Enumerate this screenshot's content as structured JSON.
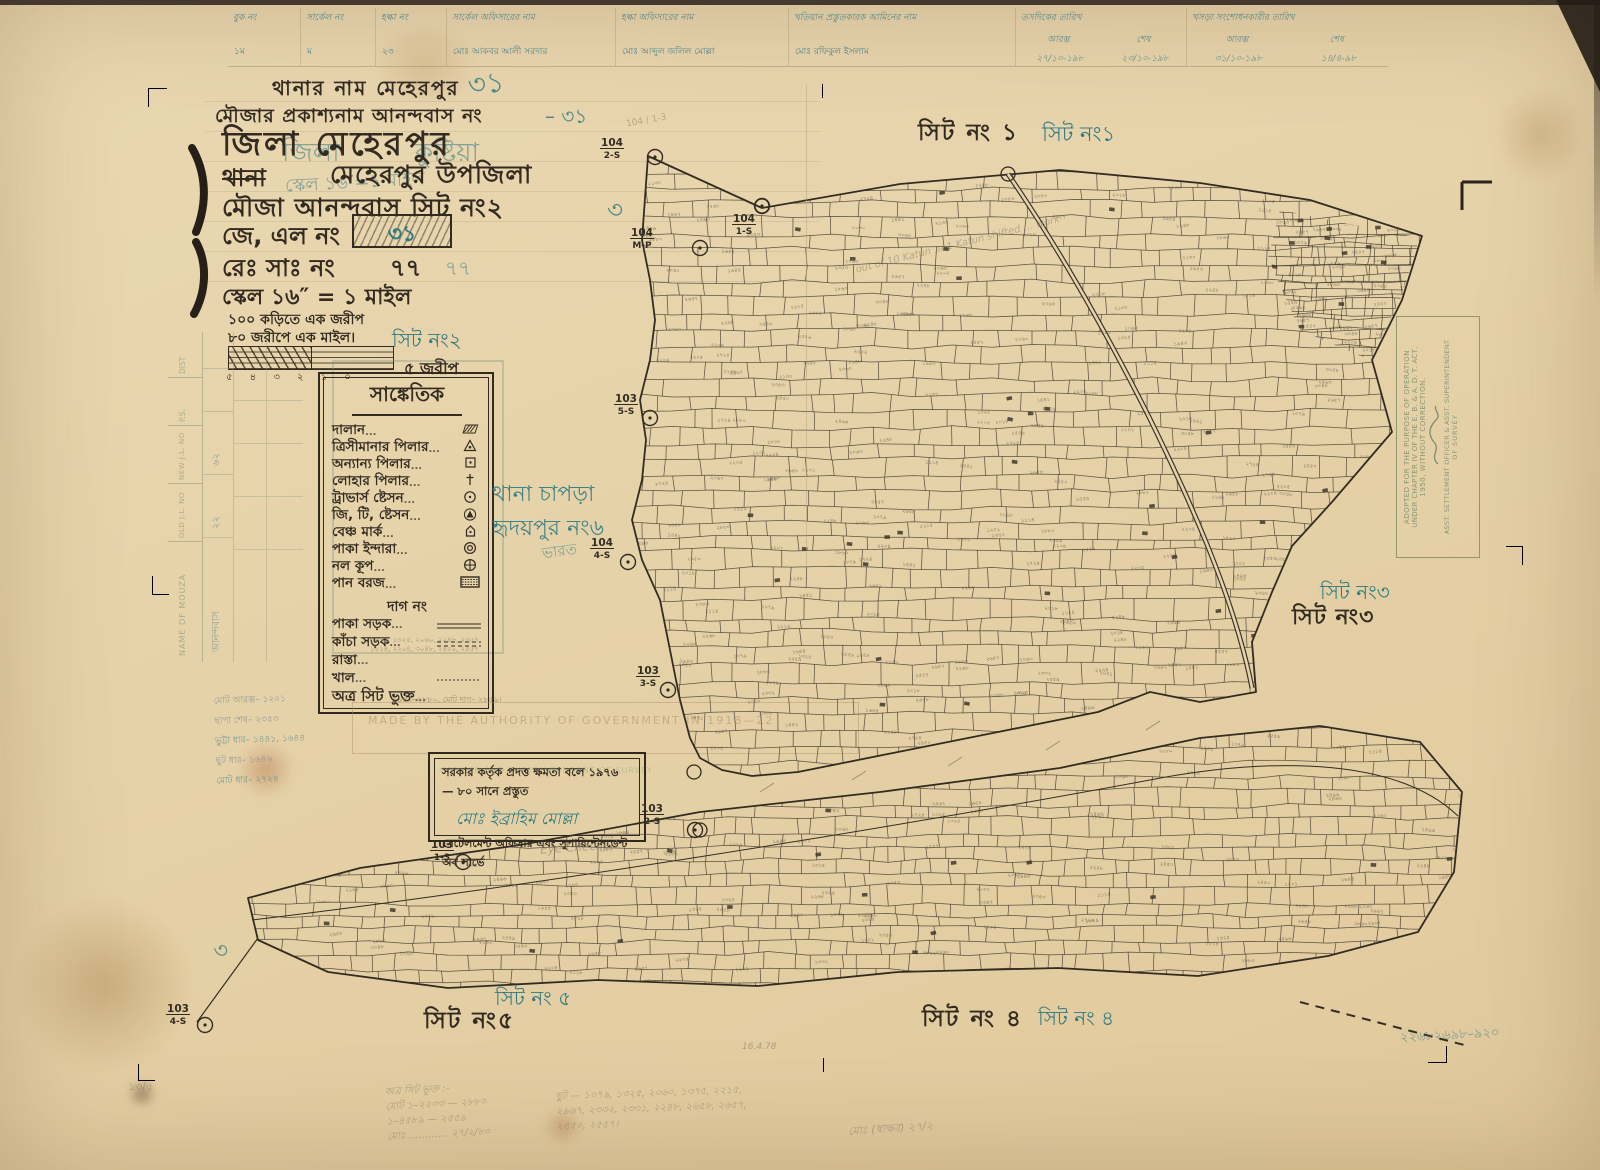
{
  "top_table": {
    "headers": [
      "বুক নং",
      "সার্কেল নং",
      "হল্কা নং",
      "সার্কেল অফিসারের নাম",
      "হল্কা অফিসারের নাম",
      "খতিয়ান প্রস্তুতকারক আমিনের নাম"
    ],
    "date_group1_label": "তসদিকের তারিখ",
    "date_group2_label": "খসড়া সংশোধনকারীর তারিখ",
    "sub_start": "আরম্ভ",
    "sub_end": "শেষ",
    "values": [
      "১ম",
      "ম",
      "২৩",
      "মোঃ আকবর আলী সরদার",
      "মোঃ আব্দুল জলিল মোল্লা",
      "মোঃ রফিকুল ইসলাম",
      "২৭/১০-১৯৮",
      "২৩/১০-১৯৮",
      "৩১/১০-১৯৮",
      "১৪/৪-৯৮"
    ]
  },
  "header": {
    "line_thana": "থানার নাম  মেহেরপুর",
    "line_mouza_name": "মৌজার প্রকাশ্যনাম  আনন্দবাস নং",
    "mouza_no_teal": "– ৩১",
    "big_31_teal": "৩১",
    "district_line": "জিলা  মেহেরপুর",
    "ghost_district": "জিলা",
    "ghost_kushtia": "কুষ্টিয়া",
    "struck_thana": "থানা",
    "ghost_scale": "স্কেল ১৬″=১ মাইল",
    "upazila": "মেহেরপুর উপজিলা",
    "mouza_line": "মৌজা   আনন্দবাস  সিট নং২",
    "jl_label": "জে, এল নং",
    "jl_value": "৩১",
    "rs_label": "রেঃ সাঃ নং",
    "rs_value": "৭৭",
    "rs_ghost": "৭৭",
    "scale_line": "স্কেল ১৬″ = ১ মাইল",
    "scale_note1": "১০০ কড়িতে এক জরীপ",
    "scale_note2": "৮০ জরীপে এক মাইল।",
    "scalebar_ticks": "৫ ৪ ৩ ২ ১ ০",
    "scalebar_right": "৫ জরীপ"
  },
  "legend": {
    "title": "সাঙ্কেতিক",
    "items": [
      {
        "label": "দালান",
        "symbol": "building"
      },
      {
        "label": "ত্রিসীমানার পিলার",
        "symbol": "tri-boundary-pillar"
      },
      {
        "label": "অন্যান্য পিলার",
        "symbol": "other-pillar"
      },
      {
        "label": "লোহার পিলার",
        "symbol": "iron-pillar"
      },
      {
        "label": "ট্রাভার্স ষ্টেসন",
        "symbol": "traverse-station"
      },
      {
        "label": "জি, টি, ষ্টেসন",
        "symbol": "gt-station"
      },
      {
        "label": "বেঞ্চ মার্ক",
        "symbol": "bench-mark"
      },
      {
        "label": "পাকা ইন্দারা",
        "symbol": "pucca-well"
      },
      {
        "label": "নল কূপ",
        "symbol": "tube-well"
      },
      {
        "label": "পান বরজ",
        "symbol": "betel-grove"
      }
    ],
    "dag_no": "দাগ নং",
    "roads": [
      {
        "label": "পাকা সড়ক"
      },
      {
        "label": "কাঁচা সড়ক"
      },
      {
        "label": "রাস্তা"
      },
      {
        "label": "খাল"
      },
      {
        "label": "অত্র সিট ভুক্ত"
      }
    ],
    "road_numbers": "১০৭৯, ১৩২৫, ২০৬০, ২২৪৮, ২৬৫৭, ১১১৪, ২২০৪, ৩০৪৮, ২৪৫০, ২৫৫৭",
    "this_sheet_note": "১৯৪৩–২৮৮০, মোট দাগ– ২৮৫৯।"
  },
  "sheet_labels": {
    "s1_black": "সিট নং ১",
    "s1_teal": "সিট নং১",
    "s2_teal": "সিট নং২",
    "s3_teal": "সিট নং৩",
    "s3_black": "সিট নং৩",
    "s4_black": "সিট নং ৪",
    "s4_teal": "সিট নং ৪",
    "s5_teal": "সিট নং ৫",
    "s5_black": "সিট নং৫"
  },
  "stations": [
    {
      "num": "104",
      "sub": "2-S",
      "lx": 612,
      "ly": 146,
      "cx": 655,
      "cy": 157
    },
    {
      "num": "104",
      "sub": "1-S",
      "lx": 744,
      "ly": 222,
      "cx": 762,
      "cy": 206
    },
    {
      "num": "104",
      "sub": "M-P",
      "lx": 642,
      "ly": 236,
      "cx": 700,
      "cy": 248
    },
    {
      "num": "103",
      "sub": "5-S",
      "lx": 626,
      "ly": 402,
      "cx": 650,
      "cy": 418
    },
    {
      "num": "104",
      "sub": "4-S",
      "lx": 602,
      "ly": 546,
      "cx": 628,
      "cy": 562
    },
    {
      "num": "103",
      "sub": "3-S",
      "lx": 648,
      "ly": 674,
      "cx": 668,
      "cy": 690
    },
    {
      "num": "103",
      "sub": "2-S",
      "lx": 652,
      "ly": 812,
      "cx": 695,
      "cy": 830
    },
    {
      "num": "103",
      "sub": "1-3",
      "lx": 442,
      "ly": 848,
      "cx": 463,
      "cy": 862
    },
    {
      "num": "103",
      "sub": "4-S",
      "lx": 178,
      "ly": 1012,
      "cx": 205,
      "cy": 1025
    }
  ],
  "annotations": {
    "thana_chapra_1": "থানা চাপড়া",
    "thana_chapra_2": "হৃদয়পুর নং৬",
    "bharat": "ভারত",
    "teal_3_left": "৩",
    "teal_3_bottom": "৩",
    "eye_checked": "Eye Checked",
    "pencil_note_ne": "out of 10 Katun … 1 Katun shifted … work",
    "pencil_station_note": "104 / 1-3",
    "pencil_date": "16.4.78",
    "bottom_right_teal": "২২৬৮২৬৯৮–৯২০",
    "bottom_left_pencil": "১৩/৫"
  },
  "stamp": {
    "lines": [
      "ADOPTED FOR THE PURPOSE OF OPERATION",
      "UNDER CHAPTER IV OF THE E. B. & A. D. T. ACT,",
      "1950, WITHOUT CORRECTION."
    ],
    "footer1": "ASST. SETTLEMENT OFFICER & ASST. SUPERINTENDENT",
    "footer2": "OF SURVEY"
  },
  "ghost_stamp": "MADE BY THE AUTHORITY OF GOVERNMENT IN 1918—22",
  "ghost_stamp2": "OFFICER AND SUPERINTENDENT OF SURVEY",
  "attestation": {
    "line1": "সরকার কর্তৃক প্রদত্ত ক্ষমতা বলে ১৯৭৬ — ৮০  সানে প্রস্তুত",
    "signature": "মোঃ ইব্রাহিম মোল্লা",
    "line2": "সেটেলমেন্ট অফিসার এবং সুপারিন্টেনডেন্ট অব সার্ভে"
  },
  "left_table": {
    "headers": [
      "NAME OF MOUZA",
      "OLD J.L. NO",
      "NEW J.L. NO",
      "P.S.",
      "DIST"
    ],
    "values": [
      "আনন্দবাস",
      "২২",
      "৬২",
      "",
      ""
    ]
  },
  "pencil_notes": {
    "left1": "অত্র সিট ভুক্ত :-",
    "left2": "মোট ১–২২০৩ — ২৮৮০",
    "left3": "১–৪৫৮৯ — ২৫৫৯",
    "left4": "মোঃ ………… ২৭/২/৮০",
    "center1": "ছুট — ১০৭৯, ১৩২৫, ২০৬০, ১৩৭৫, ২২১৫,",
    "center2": "২৯৬৭, ২৩৩২, ২৩৩১, ২২৪৮, ২৬৫৮, ২৬৫৭,",
    "center3": "২৪৫০, ২৫৫৭।",
    "right_sig": "মোঃ (স্বাক্ষর)  ২৭/২",
    "margin1": "মোট আরম্ভ– ১২০১",
    "margin2": "ছাপা শেষ– ২৩৫৩",
    "margin3": "ভুট্টা ধার– ১৪৪১, ১৬৪৪",
    "margin4": "ছুট ধার– ১৬৪৬",
    "margin5": "মোট ধার– ২৭২৪"
  },
  "map": {
    "sample_plot_numbers": [
      "২০৬০",
      "২০৬৩",
      "১০৭৯",
      "১৩২৫",
      "২৯৬৭",
      "২৩৩২",
      "২২৪৮",
      "২৬৫৮",
      "২৬৫৭",
      "২৪৫০",
      "২৫৫৭",
      "২২০৪",
      "২২০৫",
      "১১১৪",
      "৩০৪৮",
      "১৯৪৩",
      "২৮৮০",
      "১৬৪৪",
      "২৩৫৩",
      "১৪৪১",
      "২১৩০",
      "২৫৫৯",
      "১২০১",
      "২৭২৪",
      "২২৬৮",
      "২০১৮",
      "১৮৬০",
      "২৪৯৬"
    ]
  }
}
